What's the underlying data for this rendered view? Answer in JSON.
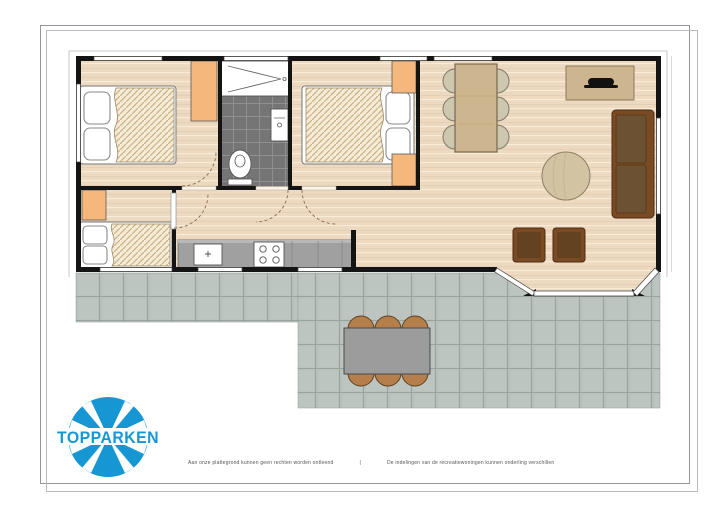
{
  "brand": {
    "name": "TOPPARKEN"
  },
  "footer": {
    "left": "Aan onze plattegrond kunnen geen rechten worden ontleend",
    "separator": "|",
    "right": "De indelingen van de recreatiewoningen kunnen onderling verschillen"
  },
  "colors": {
    "brand-blue": "#1697d4",
    "wall": "#141414",
    "floor": "#ecd9c0",
    "floor-line": "#f8ecd9",
    "wardrobe": "#f6b77c",
    "bath-tile": "#757575",
    "terrace-tile": "#b9c1bd",
    "terrace-grout": "#98a29e",
    "sofa": "#7a4a24",
    "wood": "#cdb68f",
    "counter": "#a0a0a0",
    "outdoor-chair": "#b57f4c",
    "frame": "#94949c"
  },
  "plan": {
    "rooms": [
      "bedroom-1",
      "bathroom",
      "bedroom-2",
      "bedroom-3",
      "hallway",
      "kitchen",
      "living-room",
      "dining-area",
      "terrace"
    ],
    "furniture": [
      "double-bed",
      "double-bed",
      "single-bed",
      "wardrobe-x4",
      "shower",
      "toilet",
      "washbasin",
      "kitchen-counter-sink-hob",
      "dining-table-six-chairs",
      "sideboard-with-tv",
      "sofa",
      "round-rug",
      "armchair-x2",
      "outdoor-table-six-chairs"
    ]
  }
}
